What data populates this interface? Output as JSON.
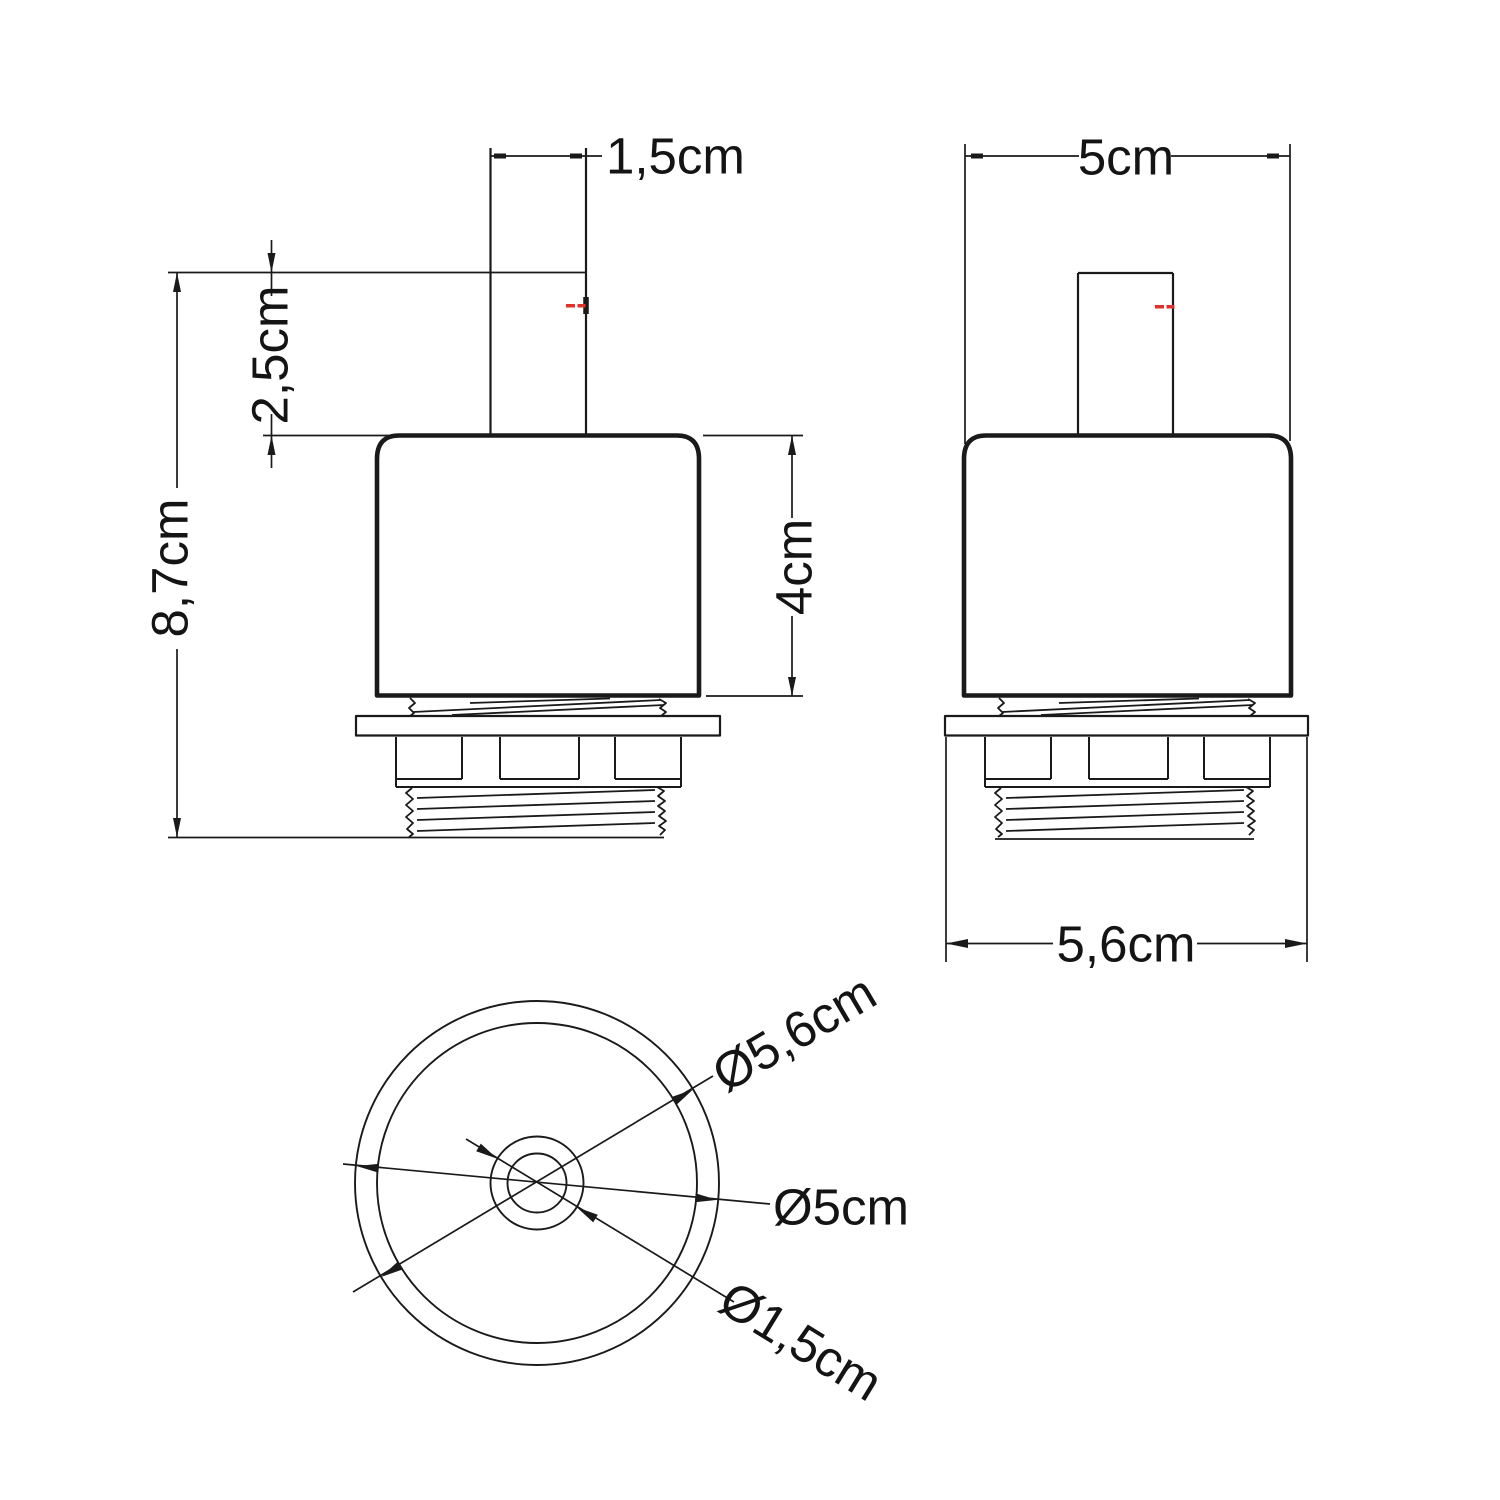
{
  "colors": {
    "line": "#1a1a1a",
    "accent_red": "#e03228",
    "background": "#ffffff"
  },
  "front_view": {
    "stem_width_label": "1,5cm",
    "stem_height_label": "2,5cm",
    "total_height_label": "8,7cm",
    "body_height_label": "4cm"
  },
  "side_view": {
    "body_width_label": "5cm",
    "flange_width_label": "5,6cm"
  },
  "top_view": {
    "flange_diameter_label": "Ø5,6cm",
    "body_diameter_label": "Ø5cm",
    "stem_diameter_label": "Ø1,5cm"
  }
}
